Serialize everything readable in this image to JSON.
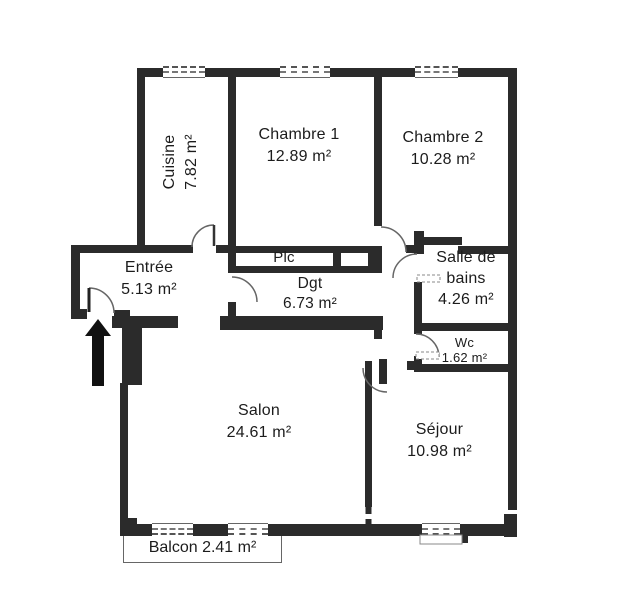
{
  "rooms": [
    {
      "name": "Cuisine",
      "area": "7.82 m²"
    },
    {
      "name": "Chambre 1",
      "area": "12.89 m²"
    },
    {
      "name": "Chambre 2",
      "area": "10.28 m²"
    },
    {
      "name": "Entrée",
      "area": "5.13 m²"
    },
    {
      "name": "Plc",
      "area": ""
    },
    {
      "name": "Dgt",
      "area": "6.73 m²"
    },
    {
      "name": "Salle de bains",
      "area": "4.26 m²"
    },
    {
      "name": "Wc",
      "area": "1.62 m²"
    },
    {
      "name": "Salon",
      "area": "24.61 m²"
    },
    {
      "name": "Séjour",
      "area": "10.98 m²"
    },
    {
      "name": "Balcon",
      "area": "2.41 m²"
    }
  ],
  "colors": {
    "wall": "#2b2b2b",
    "text": "#1c1c1c",
    "background": "#ffffff",
    "door_line": "#666666"
  }
}
